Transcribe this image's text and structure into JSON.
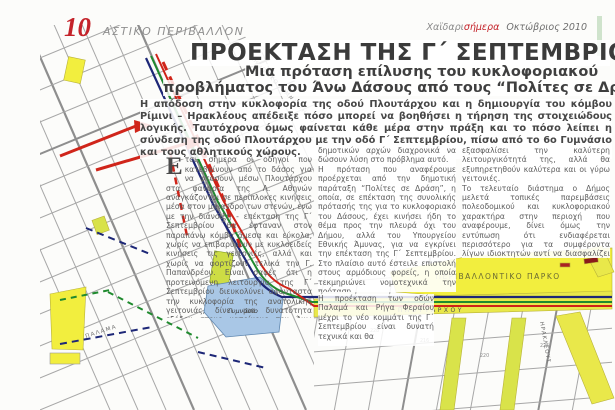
{
  "header": {
    "page_number": "10",
    "section": "ΑΣΤΙΚΟ ΠΕΡΙΒΑΛΛΟΝ",
    "masthead_gray": "Χαϊδαρι",
    "masthead_red": "σήμερα",
    "masthead_issue": "Οκτώβριος 2010"
  },
  "article": {
    "headline": "ΠΡΟΕΚΤΑΣΗ ΤΗΣ Γ΄ ΣΕΠΤΕΜΒΡΙΟΥ",
    "subhead_line1": "Μια πρόταση επίλυσης του κυκλοφοριακού",
    "subhead_line2": "προβλήματος του Άνω Δάσους από τους “Πολίτες σε Δράση”",
    "lead": "Η απόδοση στην κυκλοφορία της οδού Πλουτάρχου και η δημιουργία του κόμβου Ρίμινι – Ηρακλέους απέδειξε πόσο μπορεί να βοηθήσει η τήρηση της στοιχειώδους λογικής. Ταυτόχρονα όμως φαίνεται κάθε μέρα στην πράξη και το πόσο λείπει η σύνδεση της οδού Πλουτάρχου με την οδό Γ΄ Σεπτεμβρίου, πίσω από το 6ο Γυμνάσιο και τους αθλητικούς χώρους.",
    "dropcap": "Ε",
    "col1": "τσι, σήμερα οι οδηγοί που κατεβαίνουν από το δάσος για να φτάσουν μέσω Πλουτάρχου στα φανάρια της Λ. Αθηνών αναγκάζονται σε περίπλοκες κινήσεις μέσα στον μαίανδρο των στενών, ενώ με την διάνοιξη - επέκταση της Γ΄ Σεπτεμβρίου θα έφταναν στον παραπάνω κόμβο άμεσα και εύκολα, χωρίς να επιβαρύνουν με κυκλοειδείς κινήσεις τις γειτονιές, αλλά και χωρίς να φορτίζουν τελικά την Γ. Παπανδρέου. Είναι σαφές ότι η προτεινόμενη λειτουργία της Γ΄ Σεπτεμβρίου διευκολύνει αφάνταστα την κυκλοφορία της ανατολικής γειτονιάς, δίνει μια δυνατότητα εξόδου στους κατοίκους του Άνω Δάσους, που ασφυκτιούν από την αδυναμία των",
    "col2": "δημοτικών αρχών διαχρονικά να δώσουν λύση στο πρόβλημα αυτό.\nΗ πρόταση που αναφέρουμε προέρχεται από την δημοτική παράταξη “Πολίτες σε Δράση”, η οποία, σε επέκταση της συνολικής πρότασής της για το κυκλοφοριακό του Δάσους, έχει κινήσει ήδη το θέμα προς την πλευρά όχι του Δήμου, αλλά του Υπουργείου Εθνικής Άμυνας, για να εγκρίνει την επέκταση της Γ΄ Σεπτεμβρίου. Στο πλαίσιο αυτό έστειλε επιστολή στους αρμόδιους φορείς, η οποία τεκμηριώνει νομοτεχνικά την πρόταση.\nΠρέπει να σημειωθεί ότι για να πραγματιστεί η πρόταση δεν απαιτείται άλλη παραχώρηση γης από το ΥΕΘΑ, αν βέβαια ισχύσει τελικά η υπόσχεση της προηγούμενης κυβέρνησης για την απόδοση στην τοπική κοινωνία 68 στρεμμάτων, παράλληλα με την οδό Μπουμπουλίνας, από τις αθλητικές εγκαταστάσεις μέχρι το Πάρκο ιστορικής Μνήμης.",
    "col2b": "Η προέκταση των οδών Παλαμά και Ρήγα Φεραίου μέχρι το νέο κομμάτι της Γ΄ Σεπτεμβρίου είναι δυνατή τεχνικά και θα",
    "col3": "εξασφαλίσει την καλύτερη λειτουργικότητά της, αλλά θα εξυπηρετηθούν καλύτερα και οι γύρω γειτονιές.\nΤο τελευταίο διάστημα ο Δήμος μελετά τοπικές παρεμβάσεις πολεοδομικού και κυκλοφοριακού χαρακτήρα στην περιοχή που αναφέρουμε, δίνει όμως την εντύπωση ότι ενδιαφέρεται περισσότερο για τα συμφέροντα λίγων ιδιοκτητών αντί να διασφαλίζει το κοινό συμφέρον. Η συμπολίτευση και η αντιπολίτευση έχουν υποχρέωση να μελετήσουν σοβαρά την πρόταση των “Πολιτών σε Δράση” για να αποφύγουν λάθη και να δώσουν σωτήρια λύση στο κυκλοφοριακό πρόβλημα του Δάσους."
  },
  "map": {
    "labels": {
      "park": "ΠΕΡΙΒΑΛΛΟΝΤΙΚΟ ΠΑΡΚΟ",
      "gymnasio": "Γυμνάσιο",
      "ploutarchou": "ΠΛΟΥΤΑΡΧΟΥ",
      "palama": "ΠΑΛΑΜΑ",
      "stadium": "ΔΗΜΟΤΙΚΟ ΓΥΜΝΑΣΤΗΡΙΟ",
      "irakleous": "ΗΡΑΚΛΕΟΥΣ",
      "septemvriou": "Γ΄ ΣΕΠΤΕΜΒΡΙΟΥ"
    },
    "block_numbers": [
      "216",
      "220",
      "225",
      "228"
    ],
    "colors": {
      "route_red": "#cf2318",
      "route_navy": "#1d2777",
      "route_green": "#1f8a2e",
      "park_yellow": "#f2ee3e",
      "street_yellow": "#d9e34a",
      "gym_blue": "#a9c7e6",
      "accent_red": "#c4232a"
    }
  }
}
